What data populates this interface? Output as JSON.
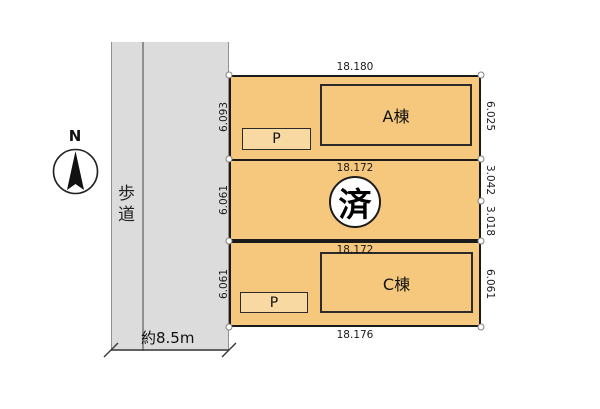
{
  "colors": {
    "lot_fill": "#f5c87d",
    "parking_fill": "#f8d9a2",
    "road_fill": "#dcdcdc",
    "outline": "#1a1a1a"
  },
  "compass": {
    "north_label": "N"
  },
  "road": {
    "sidewalk_label": "歩道",
    "width_label": "約8.5m"
  },
  "lots": [
    {
      "id": "lot-a",
      "top_dim": "18.180",
      "left_dim": "6.093",
      "right_dims": [
        "6.025"
      ],
      "building_label": "A棟",
      "parking_label": "P"
    },
    {
      "id": "lot-b",
      "top_dim": "18.172",
      "left_dim": "6.061",
      "right_dims": [
        "3.042",
        "3.018"
      ],
      "status_label": "済"
    },
    {
      "id": "lot-c",
      "top_dim": "18.172",
      "bottom_dim": "18.176",
      "left_dim": "6.061",
      "right_dims": [
        "6.061"
      ],
      "building_label": "C棟",
      "parking_label": "P"
    }
  ]
}
